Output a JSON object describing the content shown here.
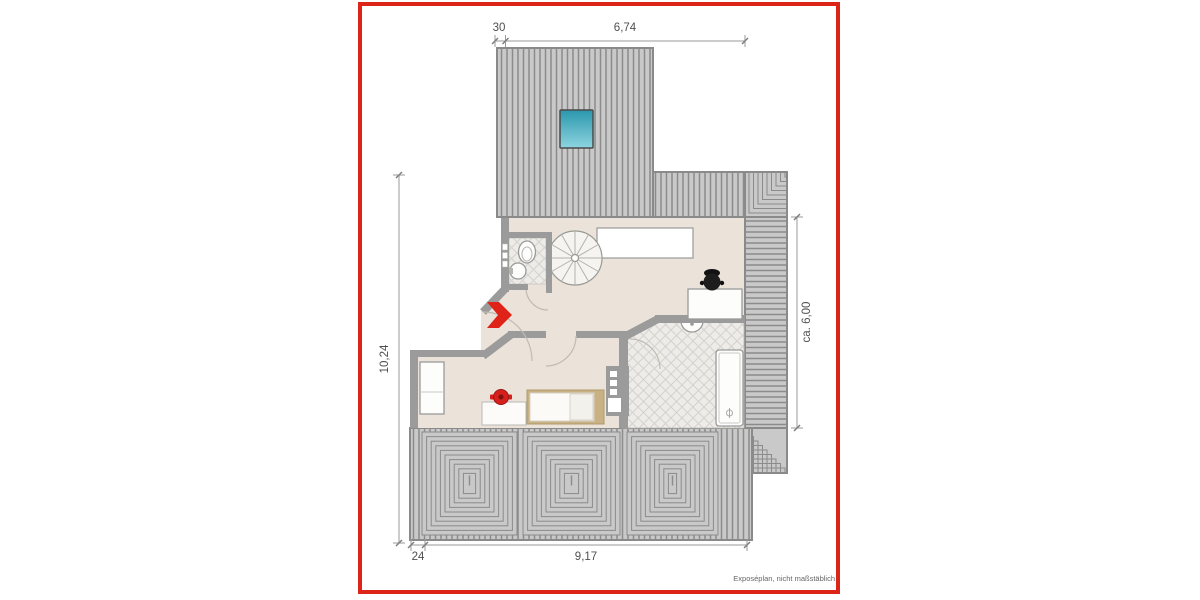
{
  "frame": {
    "border_color": "#dd2418"
  },
  "plan": {
    "dimensions": {
      "top_small": "30",
      "top_main": "6,74",
      "left_main": "10,24",
      "right_main": "ca. 6,00",
      "bottom_small": "24",
      "bottom_main": "9,17"
    },
    "footer_note": "Exposéplan, nicht maßstäblich",
    "colors": {
      "accent_red": "#df2318",
      "skylight_teal": "#35a8bf",
      "roof_fill": "#c9c9c9",
      "roof_line": "#8b8b8b",
      "wall_gray": "#9b9b9b",
      "floor_beige": "#ebe2da",
      "tile_bg": "#edece8",
      "wood_tan": "#c9b183",
      "chair_black": "#1d1d1d",
      "pot_red": "#d6201d"
    }
  }
}
